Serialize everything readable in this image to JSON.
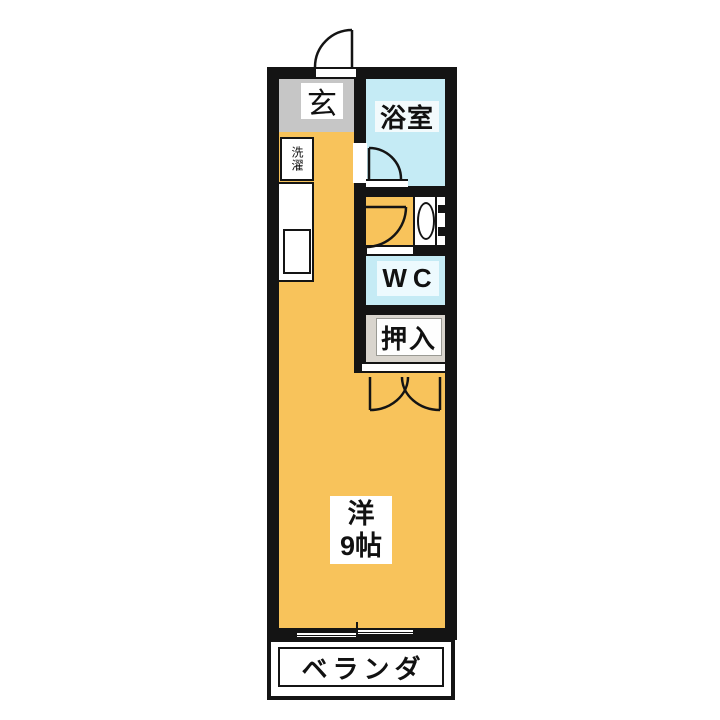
{
  "rooms": {
    "entrance": {
      "label": "玄"
    },
    "bathroom": {
      "label": "浴室"
    },
    "laundry": {
      "label": "洗濯"
    },
    "toilet": {
      "label": "WC"
    },
    "closet": {
      "label": "押入"
    },
    "main_room": {
      "label": "洋",
      "size": "9帖"
    },
    "veranda": {
      "label": "ベランダ"
    }
  },
  "colors": {
    "wall": "#141414",
    "floor_main": "#f8c35b",
    "floor_entrance": "#c6c6c6",
    "floor_wet": "#c5ebf5",
    "floor_closet": "#d9d5ce",
    "label_bg": "#ffffff"
  }
}
